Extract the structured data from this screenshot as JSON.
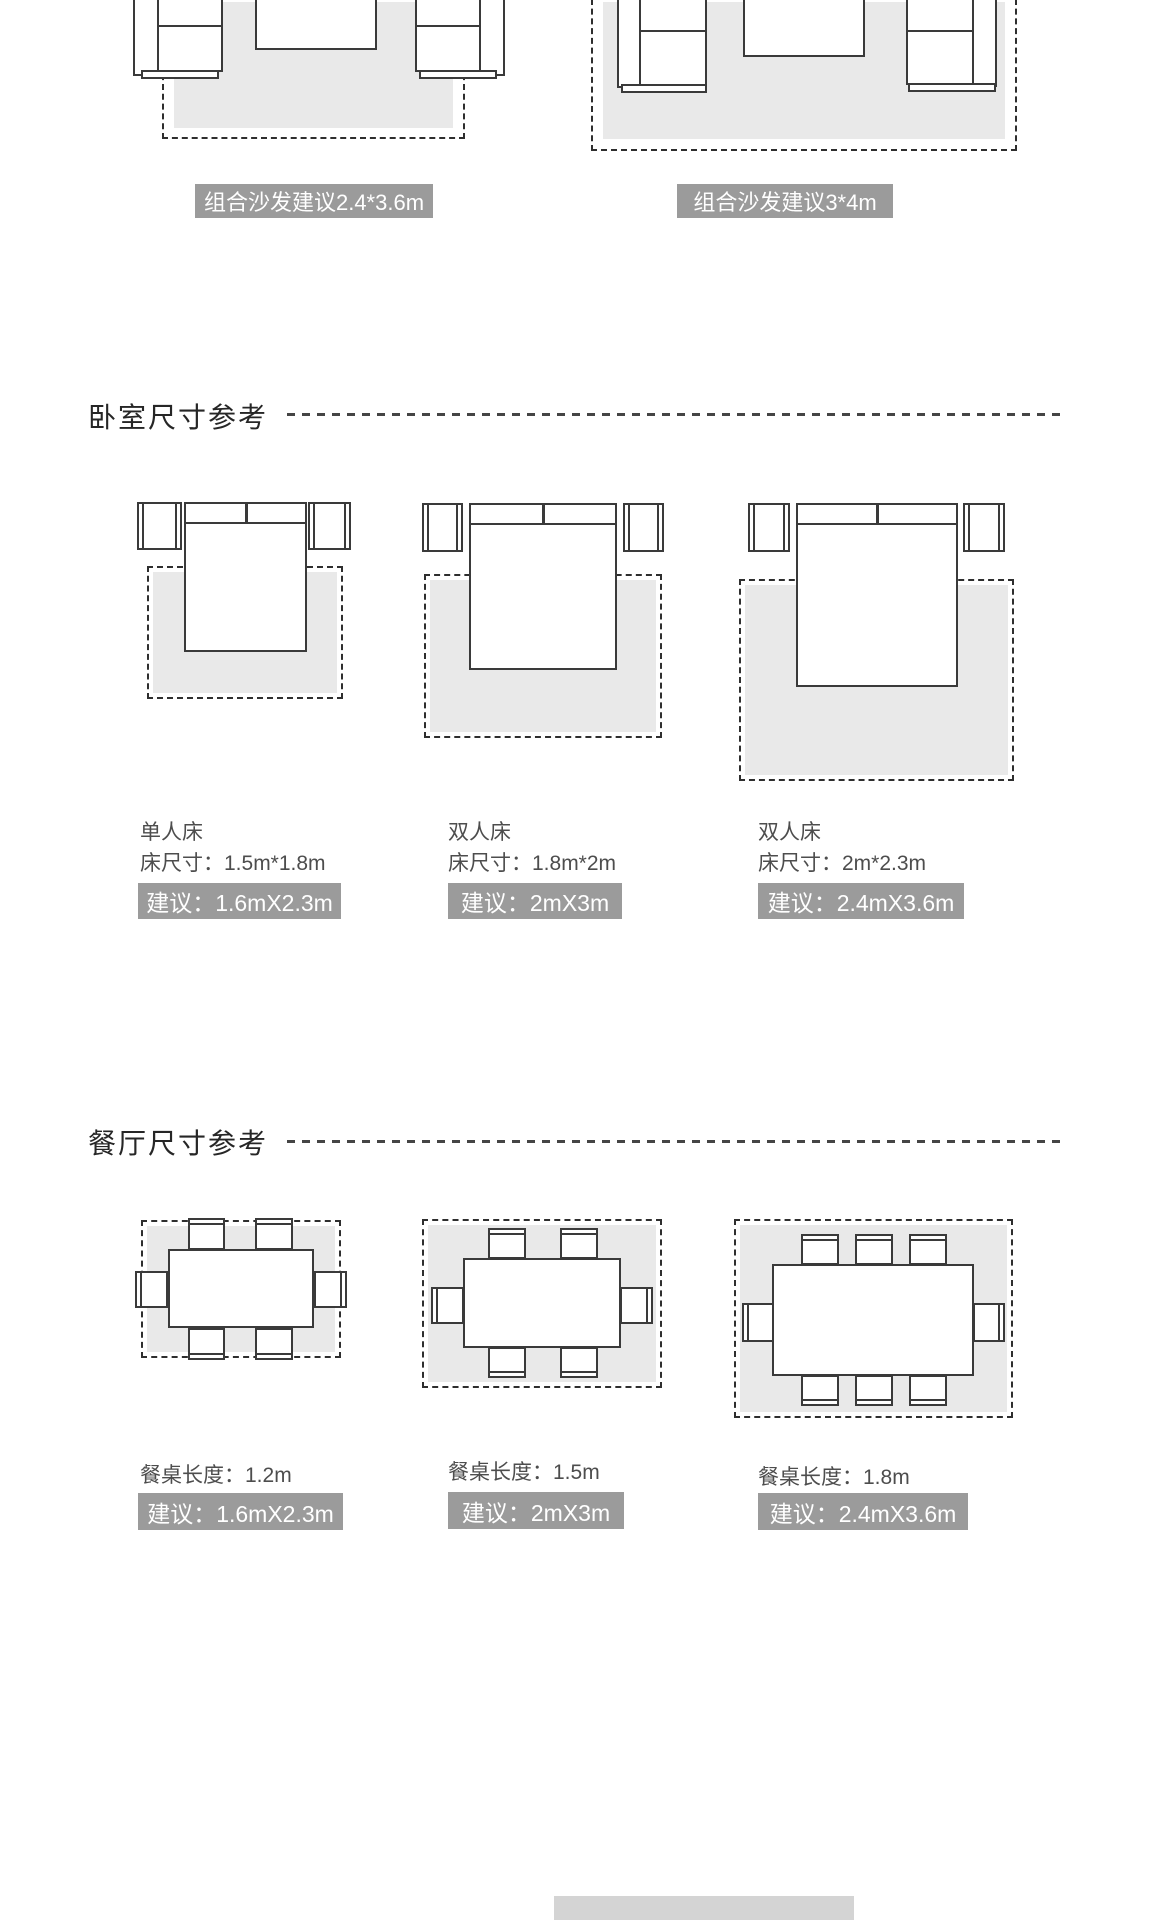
{
  "living_room": {
    "sofa_sets": [
      {
        "badge": "组合沙发建议2.4*3.6m"
      },
      {
        "badge": "组合沙发建议3*4m"
      }
    ]
  },
  "bedroom": {
    "title": "卧室尺寸参考",
    "beds": [
      {
        "name": "单人床",
        "bed_size": "床尺寸：1.5m*1.8m",
        "advice": "建议：1.6mX2.3m"
      },
      {
        "name": "双人床",
        "bed_size": "床尺寸：1.8m*2m",
        "advice": "建议：2mX3m"
      },
      {
        "name": "双人床",
        "bed_size": "床尺寸：2m*2.3m",
        "advice": "建议：2.4mX3.6m"
      }
    ]
  },
  "dining_room": {
    "title": "餐厅尺寸参考",
    "tables": [
      {
        "table_length": "餐桌长度：1.2m",
        "advice": "建议：1.6mX2.3m"
      },
      {
        "table_length": "餐桌长度：1.5m",
        "advice": "建议：2mX3m"
      },
      {
        "table_length": "餐桌长度：1.8m",
        "advice": "建议：2.4mX3.6m"
      }
    ]
  },
  "colors": {
    "badge_background": "#9b9b9b",
    "badge_text": "#ffffff",
    "rug_fill": "#e9e9e9",
    "furniture_outline": "#3a3a3a"
  }
}
